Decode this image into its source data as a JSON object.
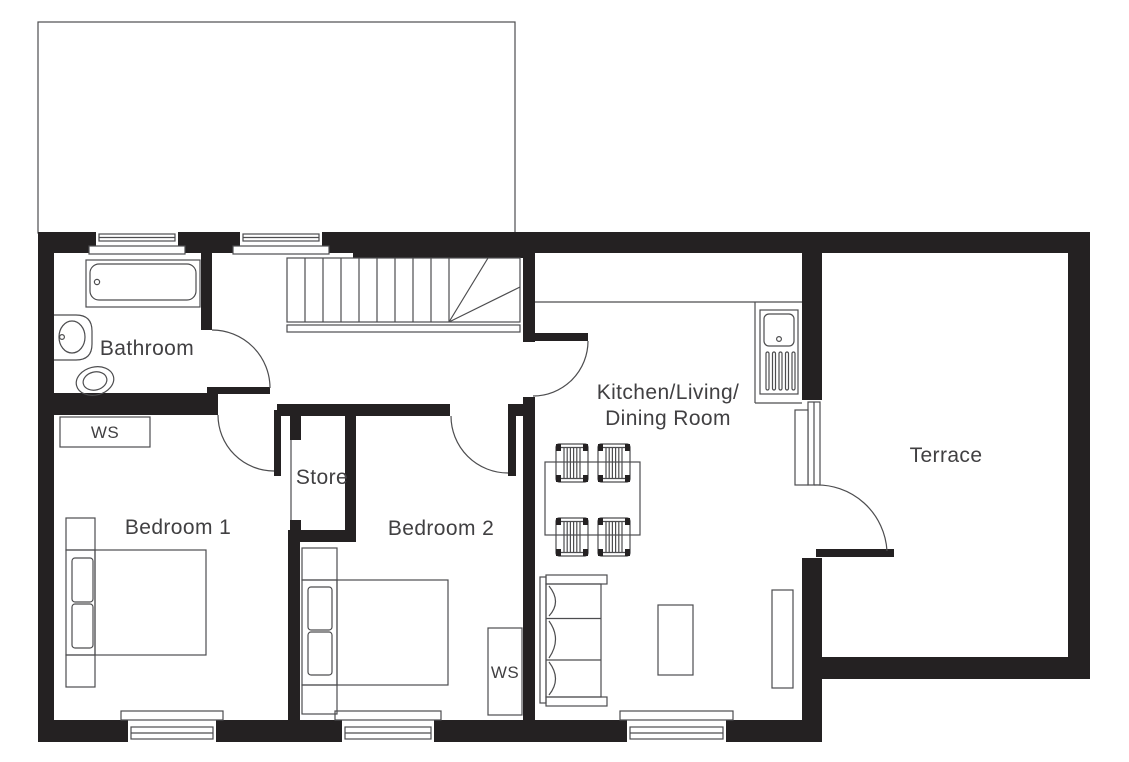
{
  "rooms": {
    "bathroom": {
      "label": "Bathroom"
    },
    "store": {
      "label": "Store"
    },
    "bedroom1": {
      "label": "Bedroom 1"
    },
    "bedroom2": {
      "label": "Bedroom 2"
    },
    "kitchen": {
      "label_line1": "Kitchen/Living/",
      "label_line2": "Dining Room"
    },
    "terrace": {
      "label": "Terrace"
    }
  },
  "annotations": {
    "ws_bedroom1": "WS",
    "ws_bedroom2": "WS"
  },
  "colors": {
    "wall": "#242122",
    "line": "#4d4d4f",
    "text": "#414042",
    "background": "#ffffff"
  }
}
